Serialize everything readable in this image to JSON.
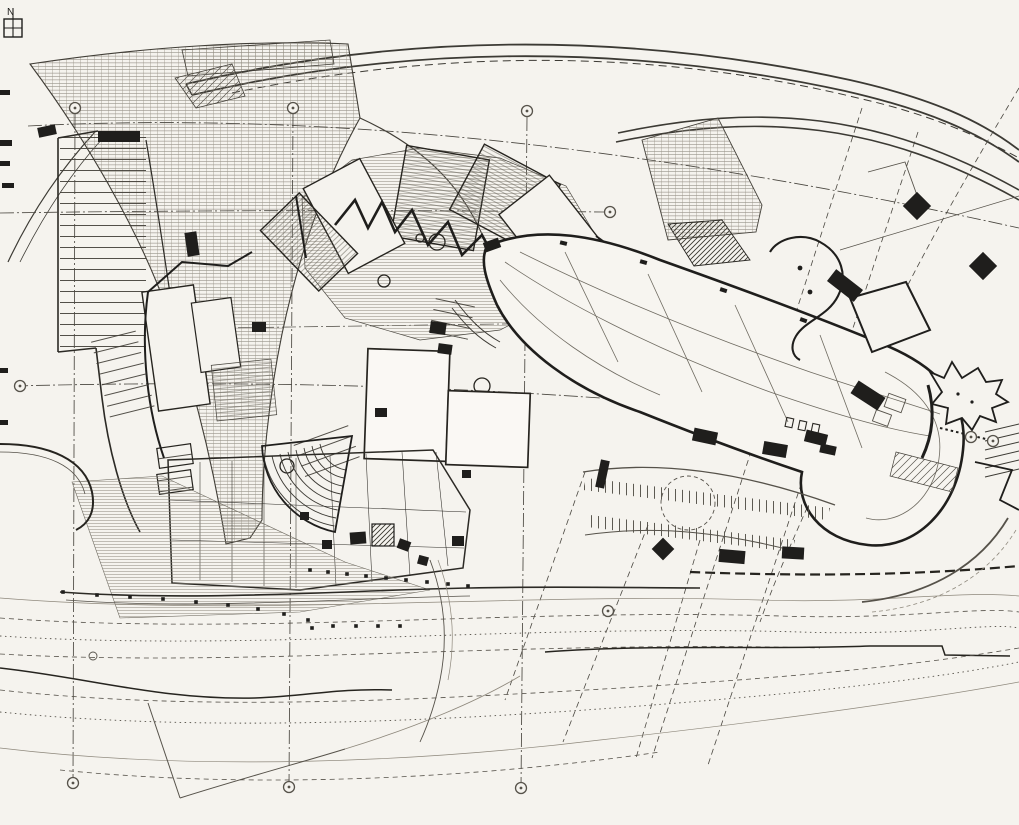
{
  "figure": {
    "type": "architectural site plan drawing",
    "north_label": "N",
    "colors": {
      "paper": "#f5f3ee",
      "ink": "#1f1e1c",
      "mid_ink": "#56524a",
      "light_ink": "#8e887c"
    },
    "grid_markers": [
      {
        "x": 75,
        "y": 108
      },
      {
        "x": 293,
        "y": 108
      },
      {
        "x": 527,
        "y": 111
      },
      {
        "x": 610,
        "y": 212
      },
      {
        "x": 20,
        "y": 386
      },
      {
        "x": 971,
        "y": 437
      },
      {
        "x": 993,
        "y": 441
      },
      {
        "x": 608,
        "y": 611
      },
      {
        "x": 73,
        "y": 783
      },
      {
        "x": 289,
        "y": 787
      },
      {
        "x": 521,
        "y": 788
      }
    ],
    "ink_blocks": [
      {
        "x": 38,
        "y": 126,
        "w": 18,
        "h": 10,
        "r": -12
      },
      {
        "x": 98,
        "y": 131,
        "w": 42,
        "h": 11,
        "r": 0
      },
      {
        "x": 186,
        "y": 232,
        "w": 12,
        "h": 24,
        "r": -8
      },
      {
        "x": 252,
        "y": 322,
        "w": 14,
        "h": 10,
        "r": 0
      },
      {
        "x": 430,
        "y": 322,
        "w": 16,
        "h": 12,
        "r": 8
      },
      {
        "x": 438,
        "y": 344,
        "w": 14,
        "h": 10,
        "r": 8
      },
      {
        "x": 375,
        "y": 408,
        "w": 12,
        "h": 9,
        "r": 0
      },
      {
        "x": 350,
        "y": 532,
        "w": 16,
        "h": 12,
        "r": -4
      },
      {
        "x": 322,
        "y": 540,
        "w": 10,
        "h": 9,
        "r": 0
      },
      {
        "x": 398,
        "y": 540,
        "w": 12,
        "h": 10,
        "r": 20
      },
      {
        "x": 452,
        "y": 536,
        "w": 12,
        "h": 10,
        "r": 0
      },
      {
        "x": 300,
        "y": 512,
        "w": 9,
        "h": 8,
        "r": 0
      },
      {
        "x": 418,
        "y": 556,
        "w": 10,
        "h": 9,
        "r": 15
      },
      {
        "x": 462,
        "y": 470,
        "w": 9,
        "h": 8,
        "r": 0
      },
      {
        "x": 484,
        "y": 240,
        "w": 16,
        "h": 10,
        "r": -20
      },
      {
        "x": 693,
        "y": 430,
        "w": 24,
        "h": 13,
        "r": 12
      },
      {
        "x": 763,
        "y": 443,
        "w": 24,
        "h": 13,
        "r": 10
      },
      {
        "x": 805,
        "y": 432,
        "w": 22,
        "h": 12,
        "r": 14
      },
      {
        "x": 828,
        "y": 278,
        "w": 34,
        "h": 15,
        "r": 38
      },
      {
        "x": 852,
        "y": 388,
        "w": 32,
        "h": 15,
        "r": 33
      },
      {
        "x": 820,
        "y": 445,
        "w": 16,
        "h": 9,
        "r": 12
      },
      {
        "x": 907,
        "y": 196,
        "w": 20,
        "h": 20,
        "r": 45
      },
      {
        "x": 973,
        "y": 256,
        "w": 20,
        "h": 20,
        "r": 45
      },
      {
        "x": 655,
        "y": 541,
        "w": 16,
        "h": 16,
        "r": 45
      },
      {
        "x": 719,
        "y": 550,
        "w": 26,
        "h": 13,
        "r": 5
      },
      {
        "x": 782,
        "y": 547,
        "w": 22,
        "h": 12,
        "r": 3
      },
      {
        "x": 598,
        "y": 460,
        "w": 9,
        "h": 28,
        "r": 12
      },
      {
        "x": 0,
        "y": 90,
        "w": 10,
        "h": 5,
        "r": 0
      },
      {
        "x": 0,
        "y": 140,
        "w": 12,
        "h": 6,
        "r": 0
      },
      {
        "x": 0,
        "y": 161,
        "w": 10,
        "h": 5,
        "r": 0
      },
      {
        "x": 2,
        "y": 183,
        "w": 12,
        "h": 5,
        "r": 0
      },
      {
        "x": 0,
        "y": 368,
        "w": 8,
        "h": 5,
        "r": 0
      },
      {
        "x": 0,
        "y": 420,
        "w": 8,
        "h": 5,
        "r": 0
      }
    ],
    "bank_dots": [
      {
        "x": 63,
        "y": 592
      },
      {
        "x": 97,
        "y": 595
      },
      {
        "x": 130,
        "y": 597
      },
      {
        "x": 163,
        "y": 599
      },
      {
        "x": 196,
        "y": 602
      },
      {
        "x": 228,
        "y": 605
      },
      {
        "x": 258,
        "y": 609
      },
      {
        "x": 284,
        "y": 614
      },
      {
        "x": 308,
        "y": 620
      },
      {
        "x": 312,
        "y": 628
      },
      {
        "x": 333,
        "y": 626
      },
      {
        "x": 356,
        "y": 626
      },
      {
        "x": 378,
        "y": 626
      },
      {
        "x": 400,
        "y": 626
      },
      {
        "x": 310,
        "y": 570
      },
      {
        "x": 328,
        "y": 572
      },
      {
        "x": 347,
        "y": 574
      },
      {
        "x": 366,
        "y": 576
      },
      {
        "x": 386,
        "y": 578
      },
      {
        "x": 406,
        "y": 580
      },
      {
        "x": 427,
        "y": 582
      },
      {
        "x": 448,
        "y": 584
      },
      {
        "x": 468,
        "y": 586
      }
    ]
  }
}
